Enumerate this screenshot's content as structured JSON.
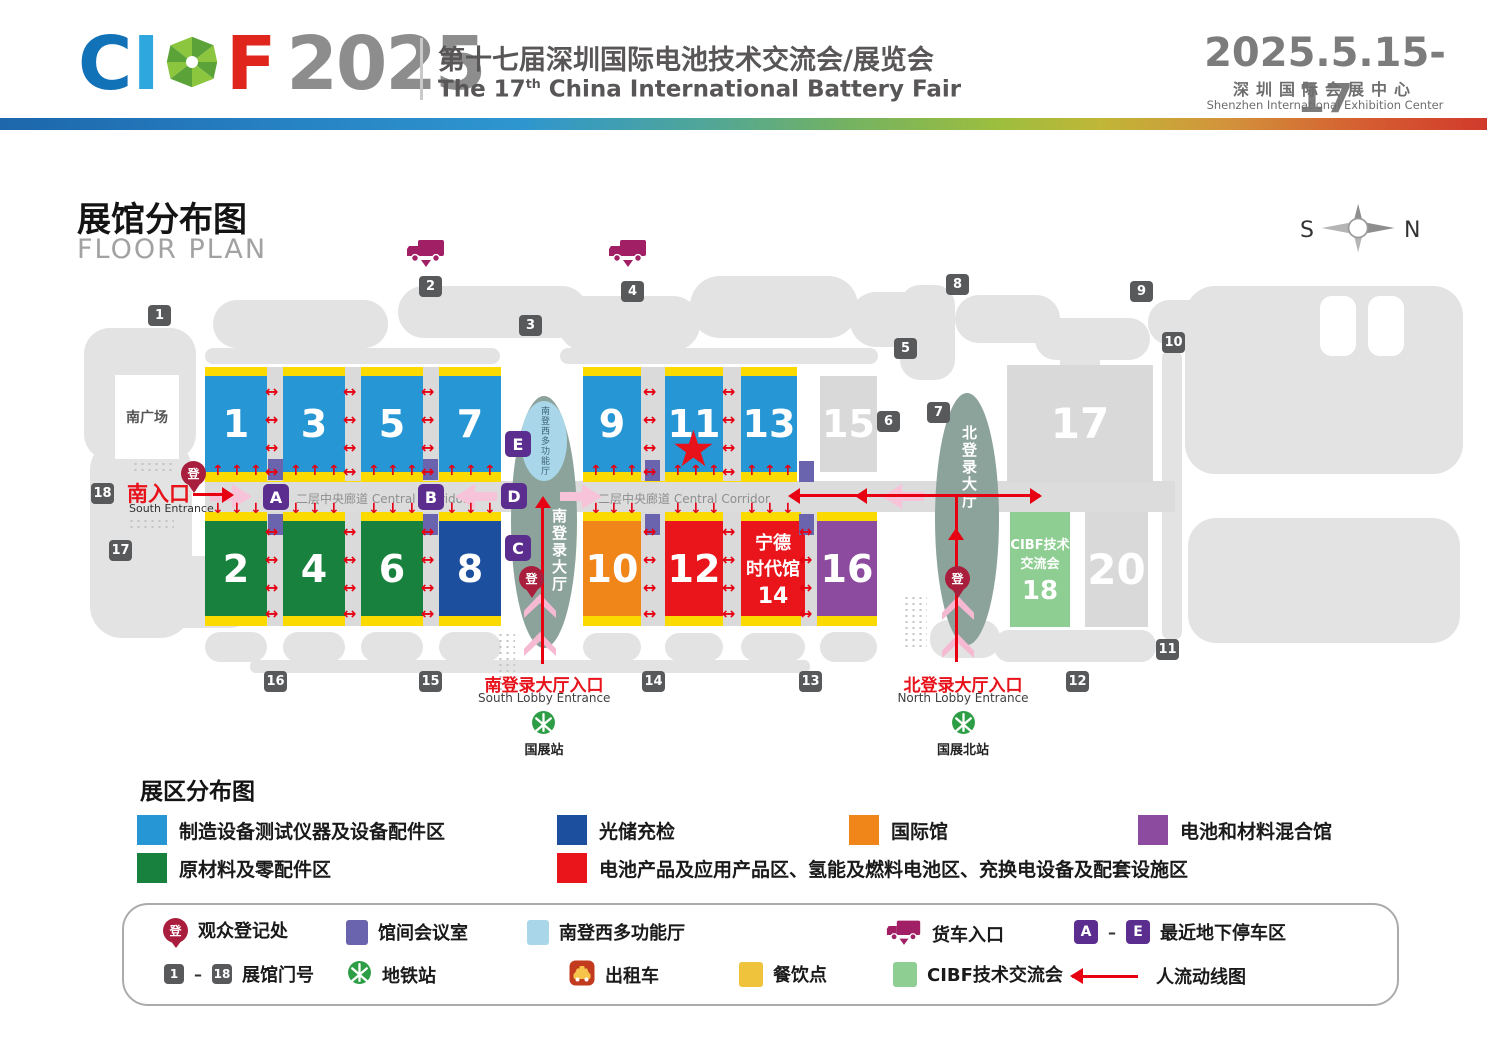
{
  "header": {
    "logo": {
      "c": "C",
      "i": "I",
      "f": "F",
      "year": "2025"
    },
    "title_cn": "第十七届深圳国际电池技术交流会/展览会",
    "title_en_pre": "The 17",
    "title_en_sup": "th",
    "title_en_post": " China International Battery Fair",
    "date": "2025.5.15-17",
    "venue_cn": "深圳国际会展中心",
    "venue_en": "Shenzhen International Exhibition Center"
  },
  "map": {
    "title_cn": "展馆分布图",
    "title_en": "FLOOR PLAN",
    "compass": {
      "left": "S",
      "right": "N"
    },
    "south_plaza": "南广场",
    "south_entrance_cn": "南入口",
    "south_entrance_en": "South Entrance",
    "corridor_label": "二层中央廊道 Central Corridor",
    "south_lobby_multi": "南登西多功能厅",
    "south_lobby_vertical": "南登录大厅",
    "north_lobby_vertical": "北登录大厅",
    "south_lobby_entrance_cn": "南登录大厅入口",
    "south_lobby_entrance_en": "South Lobby Entrance",
    "north_lobby_entrance_cn": "北登录大厅入口",
    "north_lobby_entrance_en": "North Lobby Entrance",
    "metro_south": "国展站",
    "metro_north": "国展北站",
    "reg_glyph": "登",
    "halls": [
      {
        "id": "1",
        "label": "1",
        "category": "equipment"
      },
      {
        "id": "3",
        "label": "3",
        "category": "equipment"
      },
      {
        "id": "5",
        "label": "5",
        "category": "equipment"
      },
      {
        "id": "7",
        "label": "7",
        "category": "equipment"
      },
      {
        "id": "2",
        "label": "2",
        "category": "materials"
      },
      {
        "id": "4",
        "label": "4",
        "category": "materials"
      },
      {
        "id": "6",
        "label": "6",
        "category": "materials"
      },
      {
        "id": "8",
        "label": "8",
        "category": "storage"
      },
      {
        "id": "9",
        "label": "9",
        "category": "equipment"
      },
      {
        "id": "11",
        "label": "11",
        "category": "equipment"
      },
      {
        "id": "13",
        "label": "13",
        "category": "equipment"
      },
      {
        "id": "15",
        "label": "15",
        "category": "vacant"
      },
      {
        "id": "10",
        "label": "10",
        "category": "international"
      },
      {
        "id": "12",
        "label": "12",
        "category": "battery"
      },
      {
        "id": "16",
        "label": "16",
        "category": "mixed"
      },
      {
        "id": "17",
        "label": "17",
        "category": "vacant"
      },
      {
        "id": "20",
        "label": "20",
        "category": "vacant"
      }
    ],
    "catl_hall": {
      "line1": "宁德",
      "line2": "时代馆",
      "num": "14",
      "category": "battery"
    },
    "cibf_hall": {
      "line1": "CIBF技术",
      "line2": "交流会",
      "num": "18",
      "category": "cibf"
    },
    "gates": [
      "1",
      "2",
      "3",
      "4",
      "5",
      "6",
      "7",
      "8",
      "9",
      "10",
      "11",
      "12",
      "13",
      "14",
      "15",
      "16",
      "17",
      "18"
    ],
    "parking_letters": [
      "A",
      "B",
      "C",
      "D",
      "E"
    ]
  },
  "zones_legend": {
    "title": "展区分布图",
    "items": [
      {
        "color": "#2697d4",
        "label": "制造设备测试仪器及设备配件区"
      },
      {
        "color": "#1c4f9e",
        "label": "光储充检"
      },
      {
        "color": "#f08519",
        "label": "国际馆"
      },
      {
        "color": "#8c4b9e",
        "label": "电池和材料混合馆"
      },
      {
        "color": "#18813e",
        "label": "原材料及零配件区"
      },
      {
        "color": "#e9151b",
        "label": "电池产品及应用产品区、氢能及燃料电池区、充换电设备及配套设施区"
      }
    ]
  },
  "symbols_legend": {
    "registration": "观众登记处",
    "meeting": "馆间会议室",
    "multi_hall": "南登西多功能厅",
    "truck": "货车入口",
    "parking_a": "A",
    "parking_e": "E",
    "parking": "最近地下停车区",
    "gate_1": "1",
    "gate_18": "18",
    "gate_label": "展馆门号",
    "metro": "地铁站",
    "taxi": "出租车",
    "dining": "餐饮点",
    "cibf": "CIBF技术交流会",
    "flow": "人流动线图",
    "dash": "–"
  },
  "colors": {
    "equipment": "#2697d4",
    "materials": "#18813e",
    "storage": "#1c4f9e",
    "international": "#f08519",
    "battery": "#e9151b",
    "mixed": "#8c4b9e",
    "vacant": "#d9d9d9",
    "cibf": "#8fce93",
    "yellow_strip": "#fbda00",
    "corridor": "#dcdcdc",
    "lobby": "#8ca39b",
    "multi_hall": "#a9d6e8",
    "parking_purple": "#5b2d8e",
    "meeting_purple": "#6a64ae",
    "gate_gray": "#58595b",
    "arrow_red": "#e60012",
    "pink": "#f6c3d8",
    "pin_red": "#a81e3c",
    "truck_magenta": "#a12065",
    "metro_green": "#2e9e46",
    "dining_yellow": "#f0c33c",
    "taxi_red": "#c23b1f"
  }
}
